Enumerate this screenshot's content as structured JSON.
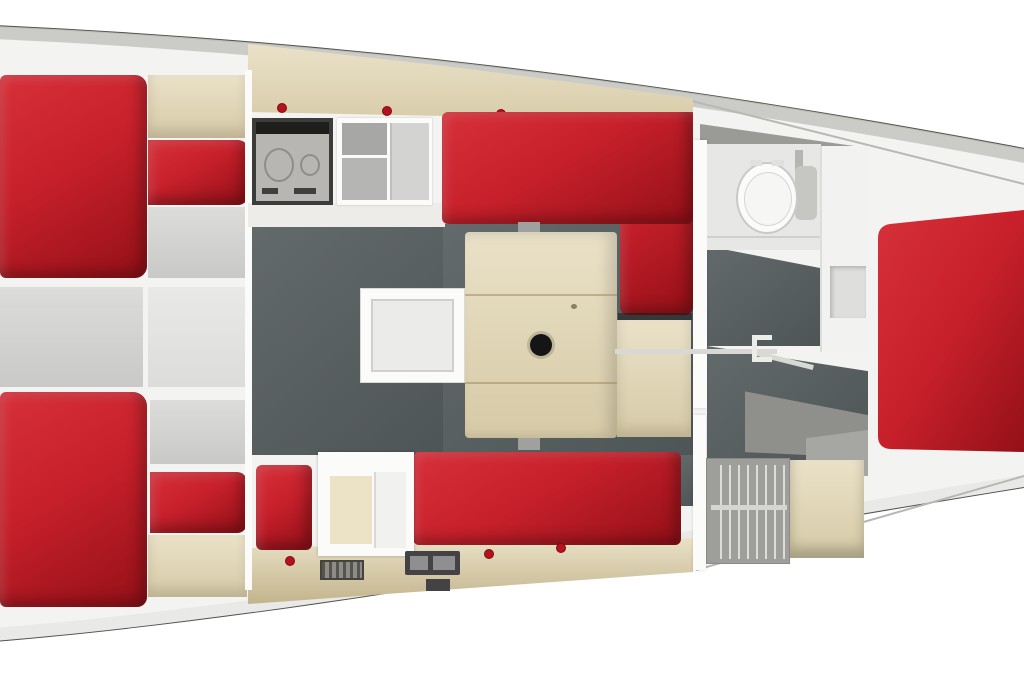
{
  "document": {
    "title": "Sailing yacht interior layout — top-down floor plan",
    "view": "top-down 3D rendered floor plan",
    "visible_text": "none",
    "orientation": "hull tapers toward the right (forward cabin right, twin aft cabins left)"
  },
  "palette": {
    "page_bg": "#ffffff",
    "hull_white": "#f3f3f1",
    "deck_band": "#c6c6c3",
    "hull_line": "#54524c",
    "seam_gray": "#b7b7b4",
    "head_band": "#9a9a96",
    "red": "#c7202b",
    "red_bright": "#d6303a",
    "red_dark": "#941017",
    "red_deep": "#7e0c14",
    "knob_red": "#b5121c",
    "wood_light": "#eae1c8",
    "wood_mid": "#d6caa6",
    "wood_dark": "#c2b48c",
    "floor_dark_1": "#636a6b",
    "floor_dark_2": "#4e5556",
    "step_gray": "#8f8f8b",
    "step_gray_light": "#a6a6a2",
    "panel_gray_1": "#dcdcda",
    "panel_gray_2": "#c9c9c7",
    "panel_gray_3": "#e9e9e7",
    "appliance_gray": "#b7b6b2",
    "stove_frame": "#3c3c3a",
    "stove_black": "#1e1e1c",
    "fixture_white": "#fbfbf9",
    "floor_hatch": "#ebebe9",
    "instrument_dark": "#434345",
    "locker_gray": "#9e9e9a",
    "mast_black": "#151515"
  },
  "rooms": [
    {
      "id": "aft-cabin-port",
      "label": "Aft cabin (port, top-left)",
      "furniture": [
        "double berth (red)",
        "wood shelf unit",
        "grey infill cushion"
      ]
    },
    {
      "id": "aft-cabin-starboard",
      "label": "Aft cabin (starboard, bottom-left)",
      "furniture": [
        "double berth (red)",
        "wood shelf unit",
        "grey infill cushion"
      ]
    },
    {
      "id": "galley",
      "label": "Galley (top centre)",
      "furniture": [
        "two-burner stove",
        "double sink with drainer",
        "wood lockers with red knobs",
        "worktop"
      ]
    },
    {
      "id": "saloon",
      "label": "Saloon / dinette (centre)",
      "furniture": [
        "L-shaped dinette seating (red)",
        "wood saloon table with mast post and recess",
        "sole access hatch",
        "wood side step"
      ]
    },
    {
      "id": "nav-station",
      "label": "Nav / chart area (bottom centre)",
      "furniture": [
        "navigator seat (red)",
        "white chart-table unit",
        "instrument panel",
        "ventilation grille",
        "straight settee (red)"
      ]
    },
    {
      "id": "head",
      "label": "Head compartment (right of centre)",
      "furniture": [
        "marine toilet",
        "plumbing hose",
        "vanity locker in wall",
        "door with handle"
      ]
    },
    {
      "id": "companionway",
      "label": "Companionway steps (grey)",
      "furniture": [
        "moulded steps"
      ]
    },
    {
      "id": "wardrobe",
      "label": "Hanging locker",
      "furniture": [
        "clothes hangers",
        "wood locker"
      ]
    },
    {
      "id": "forward-cabin",
      "label": "Forward cabin (right)",
      "furniture": [
        "large double berth (red)"
      ]
    }
  ]
}
